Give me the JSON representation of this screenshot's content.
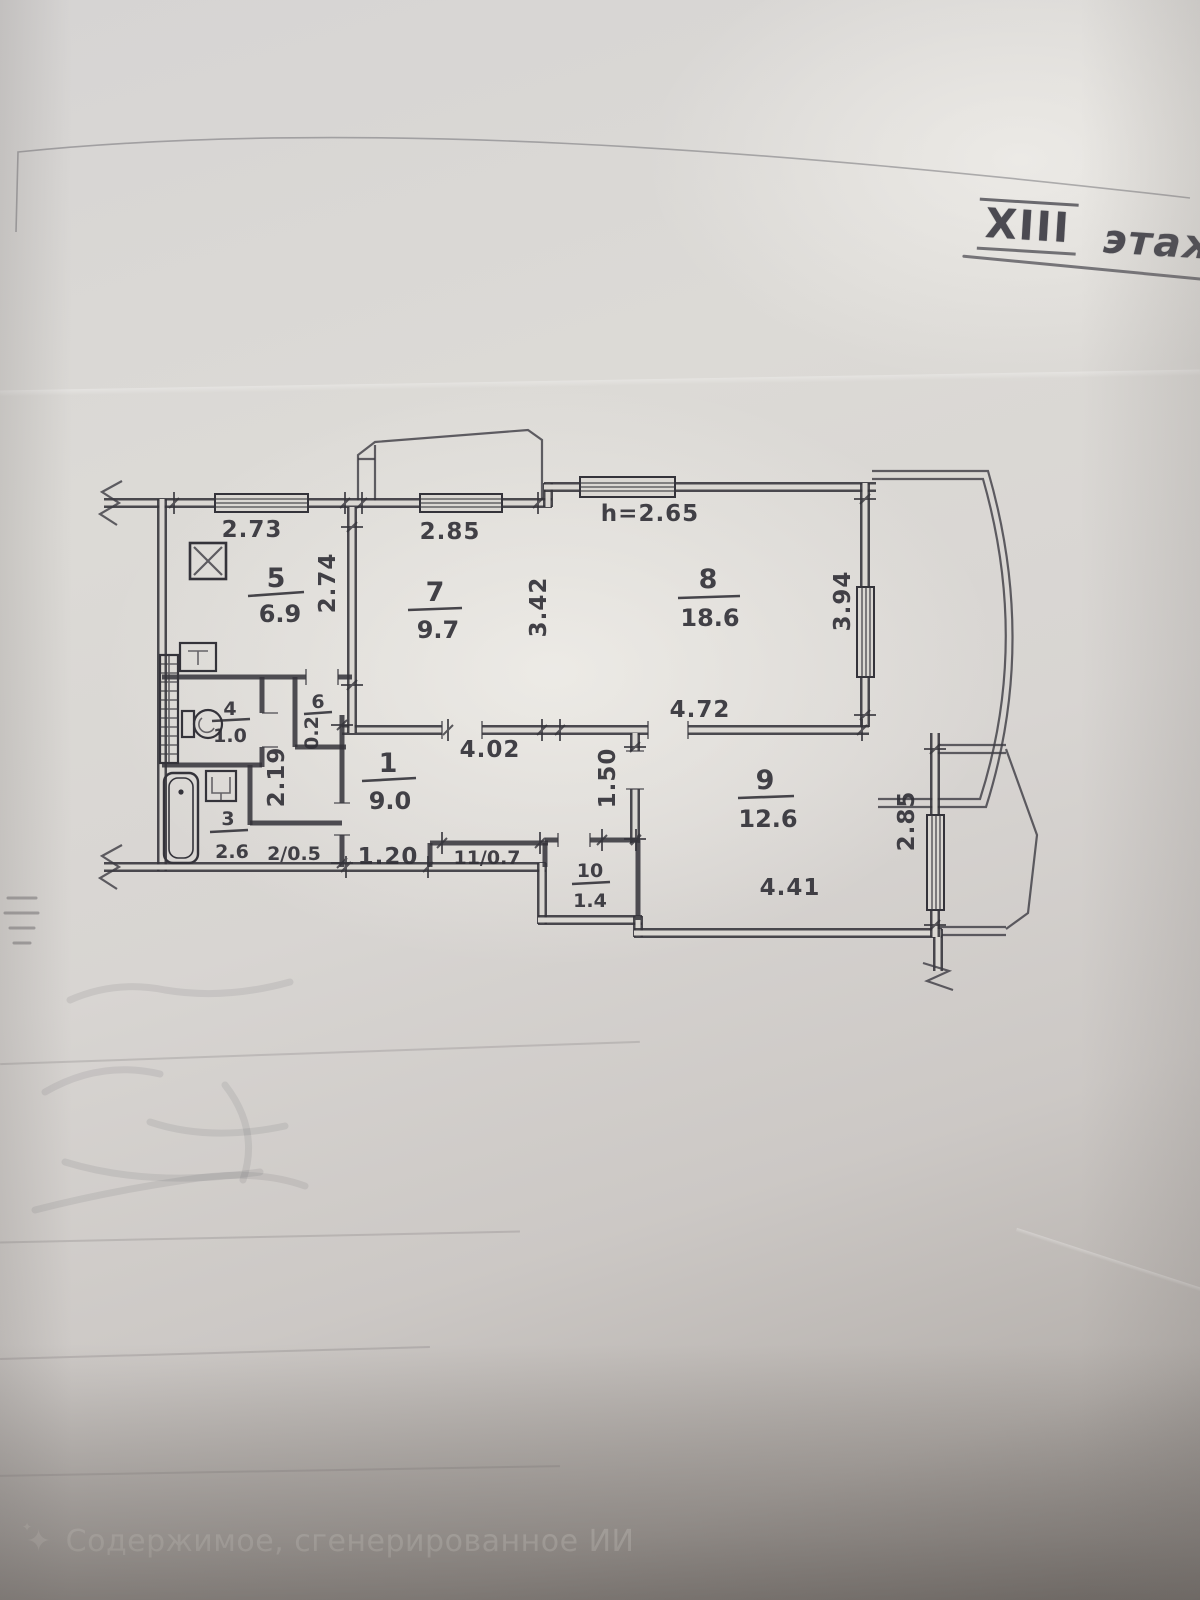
{
  "floor": {
    "roman": "XIII",
    "word": "этаж"
  },
  "plan": {
    "height_note": "h=2.65",
    "dims": {
      "kitchen_top": "2.73",
      "kitchen_right": "2.74",
      "room7_top": "2.85",
      "room7_right": "3.42",
      "room8_right": "3.94",
      "room8_bottom": "4.72",
      "hall_top": "4.02",
      "passage": "1.50",
      "hall_left": "2.19",
      "hall_bottom": "1.20",
      "room9_bottom": "4.41",
      "room9_right": "2.85"
    },
    "rooms": {
      "r1": {
        "num": "1",
        "area": "9.0"
      },
      "r2": {
        "combined": "2/0.5"
      },
      "r3": {
        "num": "3",
        "area": "2.6"
      },
      "r4": {
        "num": "4",
        "area": "1.0"
      },
      "r5": {
        "num": "5",
        "area": "6.9"
      },
      "r6": {
        "num": "6",
        "area": "0.2"
      },
      "r7": {
        "num": "7",
        "area": "9.7"
      },
      "r8": {
        "num": "8",
        "area": "18.6"
      },
      "r9": {
        "num": "9",
        "area": "12.6"
      },
      "r10": {
        "num": "10",
        "area": "1.4"
      },
      "r11": {
        "combined": "11/0.7"
      }
    }
  },
  "watermark": {
    "text": "Содержимое, сгенерированное ИИ"
  }
}
